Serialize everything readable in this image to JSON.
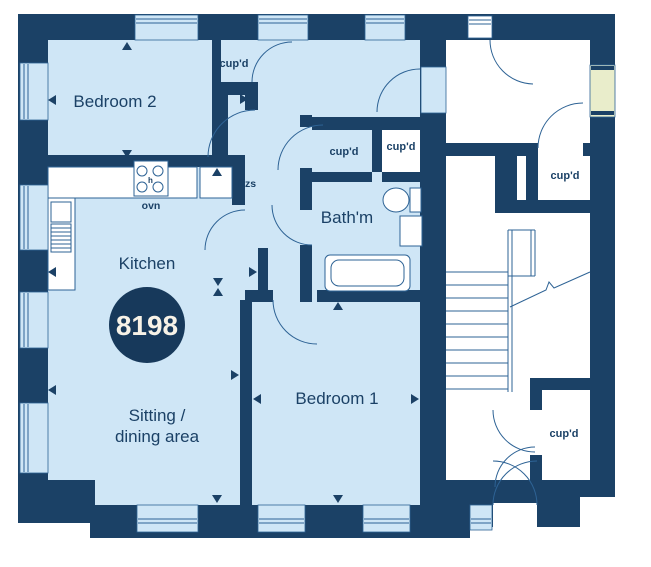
{
  "plot": {
    "number": "8198"
  },
  "rooms": {
    "bedroom2": "Bedroom 2",
    "kitchen": "Kitchen",
    "sitting_line1": "Sitting /",
    "sitting_line2": "dining area",
    "bathroom": "Bath'm",
    "bedroom1": "Bedroom 1"
  },
  "cupboards": {
    "hall_top": "cup'd",
    "bath_left": "cup'd",
    "bath_right": "cup'd",
    "communal_top": "cup'd",
    "communal_bottom": "cup'd"
  },
  "appliances": {
    "oven": "ovn",
    "fridge_freezer": "ffzs",
    "hob": "h"
  },
  "colors": {
    "wall": "#1b4166",
    "room_fill": "#cfe6f6",
    "fixture_line": "#2e6395",
    "highlight_window": "#e9edcb",
    "plot_circle": "#17395b",
    "plot_text": "#f7f2e7"
  }
}
